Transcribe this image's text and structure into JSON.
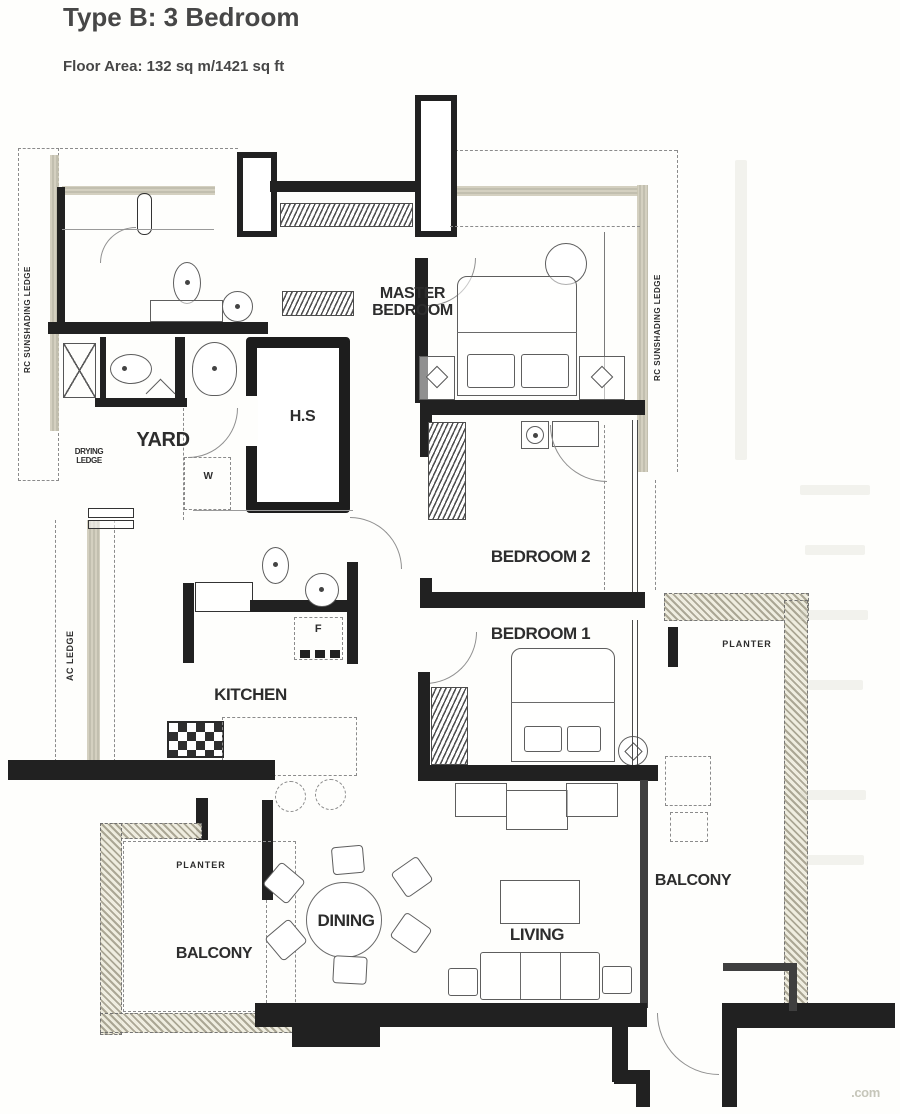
{
  "header": {
    "title": "Type B: 3 Bedroom",
    "subtitle": "Floor Area: 132 sq m/1421 sq ft"
  },
  "rooms": {
    "master_bedroom": "MASTER BEDROOM",
    "bedroom2": "BEDROOM 2",
    "bedroom1": "BEDROOM 1",
    "kitchen": "KITCHEN",
    "dining": "DINING",
    "living": "LIVING",
    "yard": "YARD",
    "hs": "H.S",
    "balcony_left": "BALCONY",
    "balcony_right": "BALCONY",
    "planter_left": "PLANTER",
    "planter_right": "PLANTER"
  },
  "ledges": {
    "drying_ledge": "DRYING LEDGE",
    "ac_ledge": "AC LEDGE",
    "rc_sunshading_left": "RC SUNSHADING LEDGE",
    "rc_sunshading_right": "RC SUNSHADING LEDGE"
  },
  "appliances": {
    "washer": "W",
    "fridge": "F"
  },
  "watermark": ".com",
  "colors": {
    "wall": "#212121",
    "furniture_line": "#5e5e5e",
    "ledge_tint": "#c9c5b1",
    "paper": "#fefefc"
  }
}
